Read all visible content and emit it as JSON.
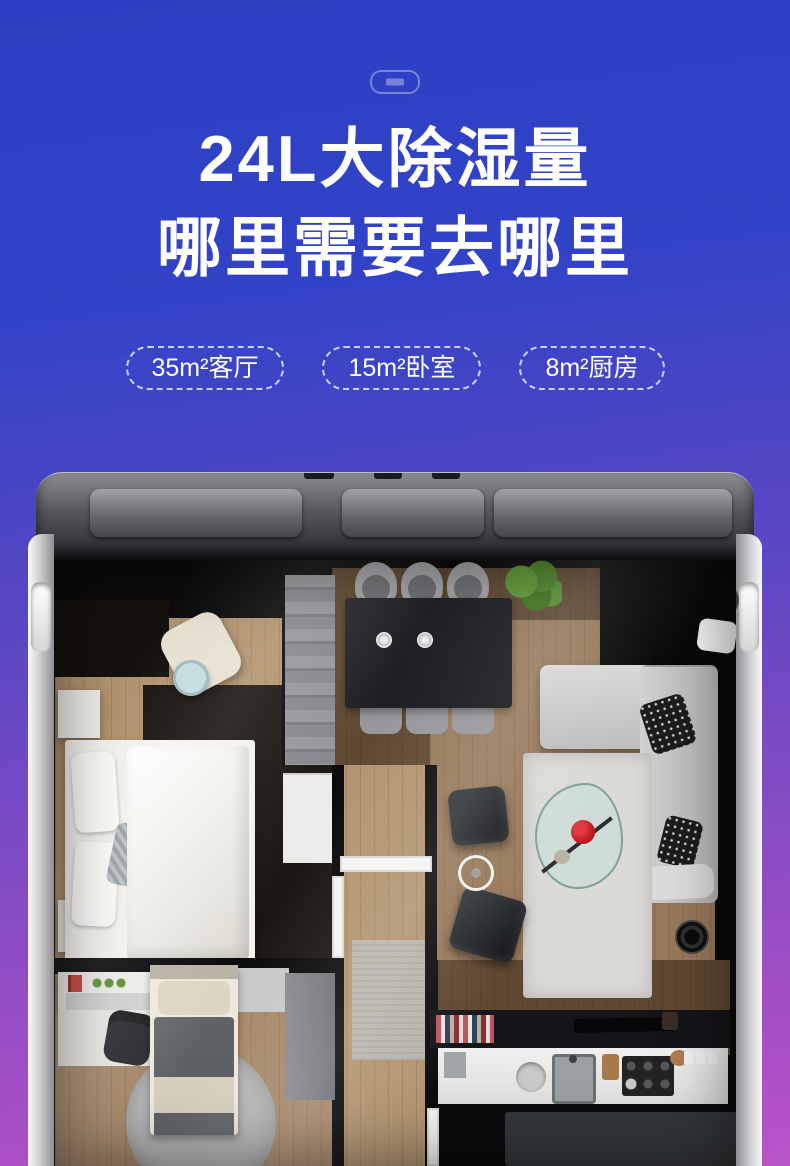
{
  "page": {
    "kind": "product-detail marketing banner",
    "bg_gradient_top": "#2b3fc2",
    "bg_gradient_bottom": "#b450c6",
    "text_color": "#ffffff"
  },
  "header": {
    "plug_icon": "power-outlet-indicator-icon"
  },
  "hero": {
    "title_line1": "24L大除湿量",
    "title_line2": "哪里需要去哪里"
  },
  "badges": [
    {
      "label": "35m²客厅"
    },
    {
      "label": "15m²卧室"
    },
    {
      "label": "8m²厨房"
    }
  ],
  "floorplan": {
    "description": "top-down 3D apartment floor plan rendered inside the dehumidifier top housing",
    "rooms": [
      "bedroom",
      "dining-area",
      "living-room",
      "hallway",
      "study-bedroom",
      "kitchen"
    ],
    "palette": {
      "shell_silver": "#d6d6d7",
      "housing_dark": "#232327",
      "wall": "#0b0b0d",
      "wood_light": "#b2946f",
      "wood_mid": "#97795a",
      "wood_dark": "#5f4832",
      "bed_white": "#f3f2ee",
      "rug_dark": "#1b1612",
      "rug_light": "#dbdad7",
      "sofa_gray": "#c9c9c7",
      "flower_red": "#d2222a",
      "plant_green": "#4e8d2e",
      "glass_table": "#bfd9d2"
    }
  }
}
